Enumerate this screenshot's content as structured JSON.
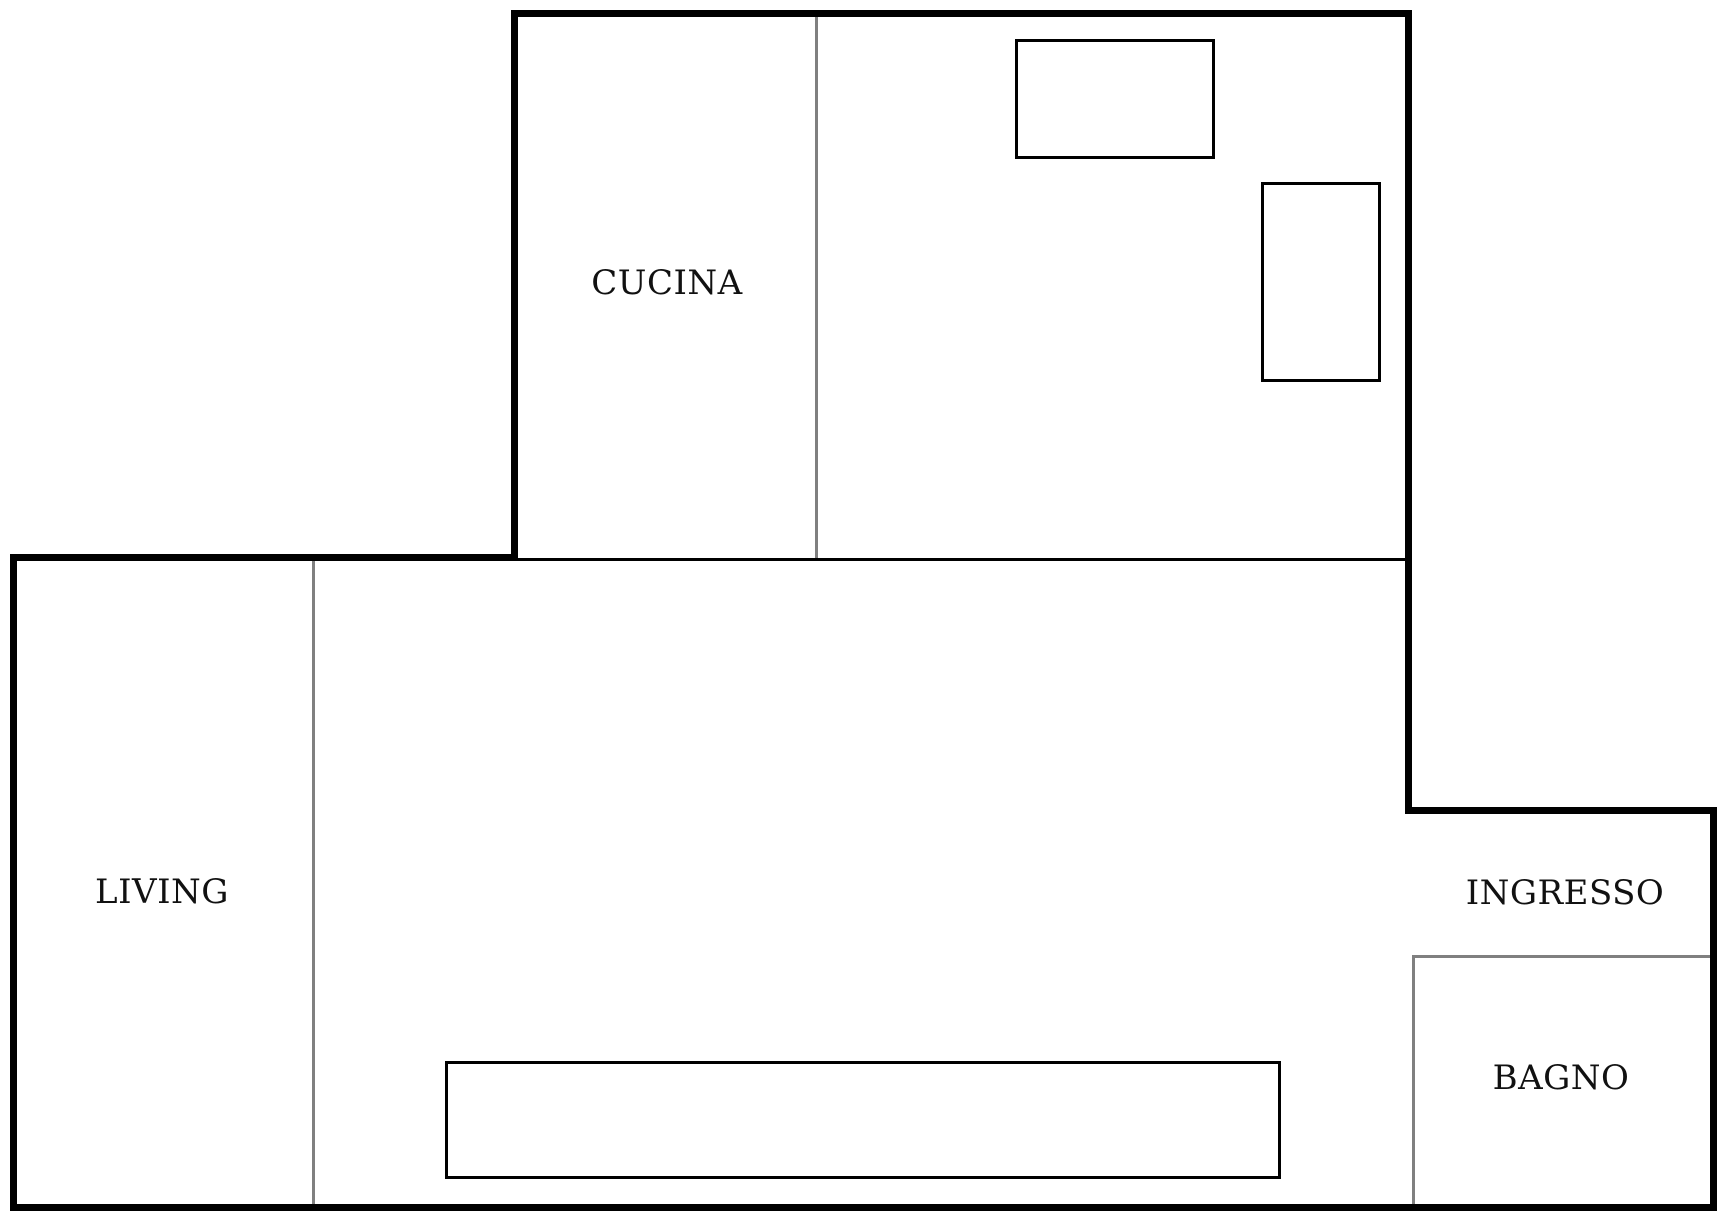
{
  "plan": {
    "rooms": {
      "cucina": {
        "label": "CUCINA"
      },
      "living": {
        "label": "LIVING"
      },
      "ingresso": {
        "label": "INGRESSO"
      },
      "bagno": {
        "label": "BAGNO"
      }
    },
    "colors": {
      "wall": "#000000",
      "room_divider": "#808080",
      "interior_boundary": "#000000",
      "furniture_outline": "#000000",
      "background": "#ffffff",
      "label_text": "#111111"
    }
  }
}
